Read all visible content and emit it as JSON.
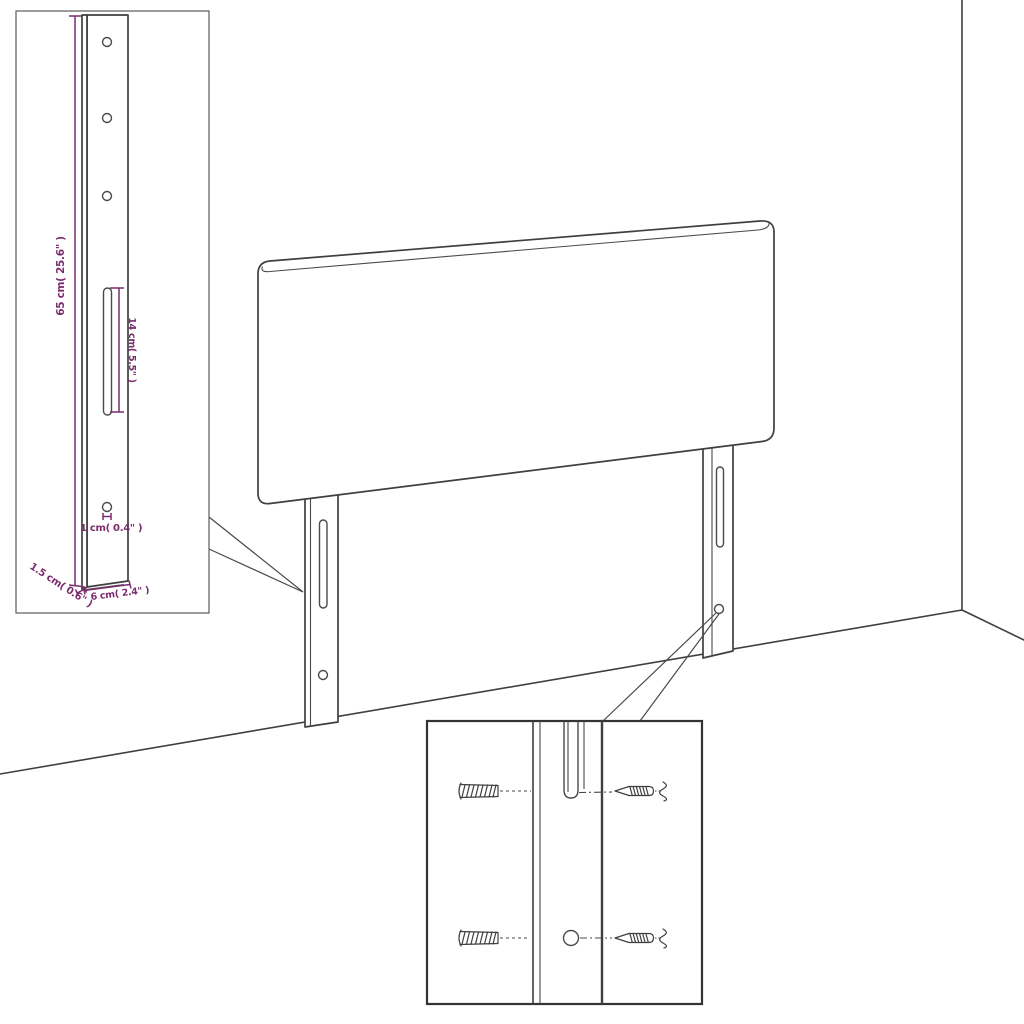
{
  "diagram": {
    "dimensions": {
      "bracket_height": "65 cm( 25.6\" )",
      "slot_length": "14 cm( 5.5\" )",
      "hole_diameter": "1 cm( 0.4\" )",
      "bracket_thickness": "1.5 cm( 0.6\" )",
      "bracket_width": "6 cm( 2.4\" )"
    },
    "colors": {
      "dimension_accent": "#7b2c6e",
      "drawing_line": "#3f3f3f",
      "background": "#ffffff"
    }
  }
}
